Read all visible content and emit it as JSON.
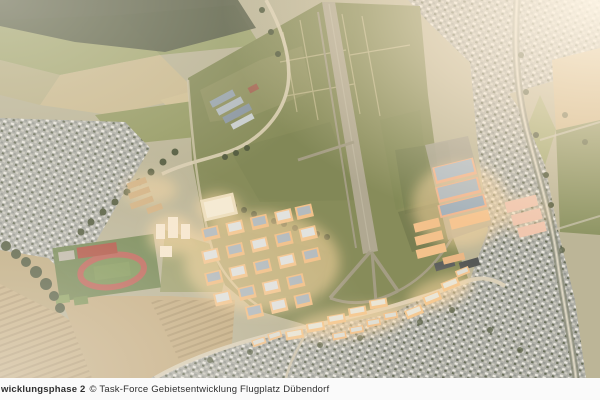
{
  "caption": {
    "phase_label": "wicklungsphase 2",
    "credit": "© Task-Force Gebietsentwicklung Flugplatz Dübendorf"
  },
  "colors": {
    "base": "#b3b093",
    "grass": "#77814e",
    "grass_dark": "#5a663c",
    "runway": "#a5a18c",
    "taxiway": "#98957e",
    "apron": "#9d9c8e",
    "forest": "#46503c",
    "tree": "#3d4a2f",
    "town": "#a4a9a6",
    "field_tan": "#c3ab7f",
    "field_green": "#8a9257",
    "road": "#d6cdb4",
    "rail": "#7e8577",
    "glow": "#ffd9a0",
    "building_wall": "#f1bd85",
    "building_roof_solar": "#aab7c0",
    "building_roof_light": "#dfe3e4",
    "hangar_salmon": "#efb28c",
    "pink_complex": "#eec3ae",
    "tower_cream": "#f7ead2",
    "hall_roof": "#f4ecd6",
    "track_red": "#b5544a",
    "pitch_green": "#6d8a4a",
    "sports_building_red": "#a63f33",
    "warehouse_blue": "#8e9fae",
    "dark_hangar": "#474e52",
    "sun_glare": "#fff3e0",
    "caption_bg": "#fafafa",
    "caption_text": "#2e2e2e"
  }
}
